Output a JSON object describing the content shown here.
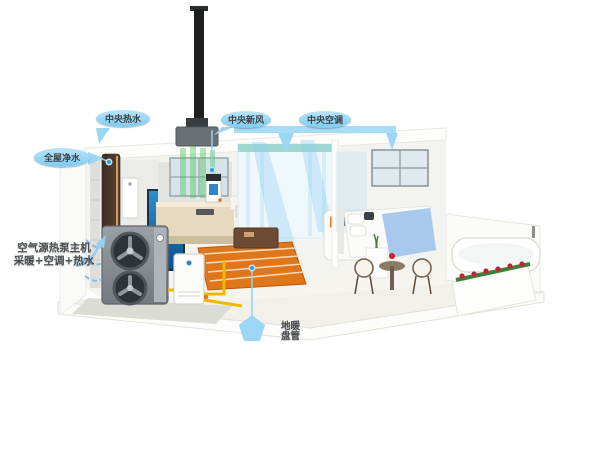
{
  "title": "air-source heat pump whole-house system cutaway",
  "labels": {
    "hot_water": {
      "text": "中央热水"
    },
    "fresh_air": {
      "text": "中央新风"
    },
    "air_conditioning": {
      "text": "中央空调"
    },
    "water_purification": {
      "text": "全屋净水"
    },
    "heat_pump": {
      "line1": "空气源热泵主机",
      "line2": "采暖+空调+热水"
    },
    "floor_heating": {
      "line1": "地暖",
      "line2": "盘管"
    }
  },
  "colors": {
    "label_pill": "#7FCBF1",
    "leader_line": "#8FD2F2",
    "anchor_dot": "#3F9AD8",
    "floor_heating_coil": "#E0761A",
    "water_pipe": "#EDB800",
    "fresh_air_flow": "#34C24A",
    "ac_flow": "#82C8F5",
    "heat_pump_body": "#8A9096",
    "flue_pipe": "#1D1F21",
    "hot_water_tank": "#4A3328",
    "bed_blanket": "#A9C8EE",
    "roses": "#C22432",
    "aquarium": "#1E78C0"
  }
}
